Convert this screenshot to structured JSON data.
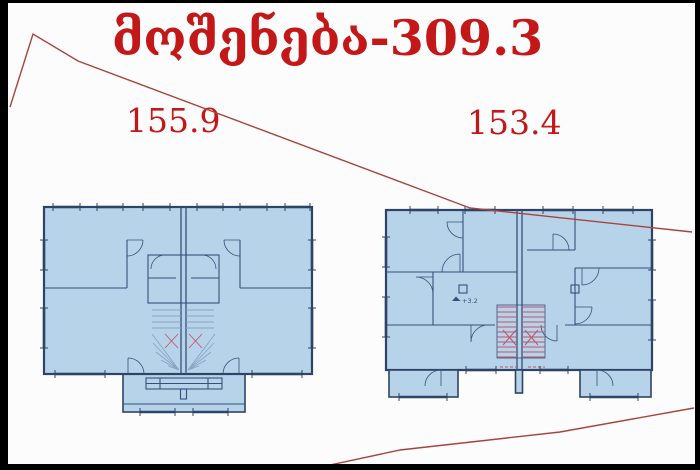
{
  "title": "მოშენება-309.3",
  "areas": {
    "left": "155.9",
    "right": "153.4"
  },
  "plans": {
    "right": {
      "level_marker": "+3.2"
    }
  },
  "colors": {
    "background": "#fcfcfc",
    "border-black": "#000000",
    "title-red": "#c31718",
    "line-red": "#a8433e",
    "plan-fill": "#b7d3ea",
    "plan-outline": "#2e4467",
    "plan-inner": "#36507a",
    "stair-gray": "#8ba3c2",
    "stair-red": "#c0566b"
  }
}
